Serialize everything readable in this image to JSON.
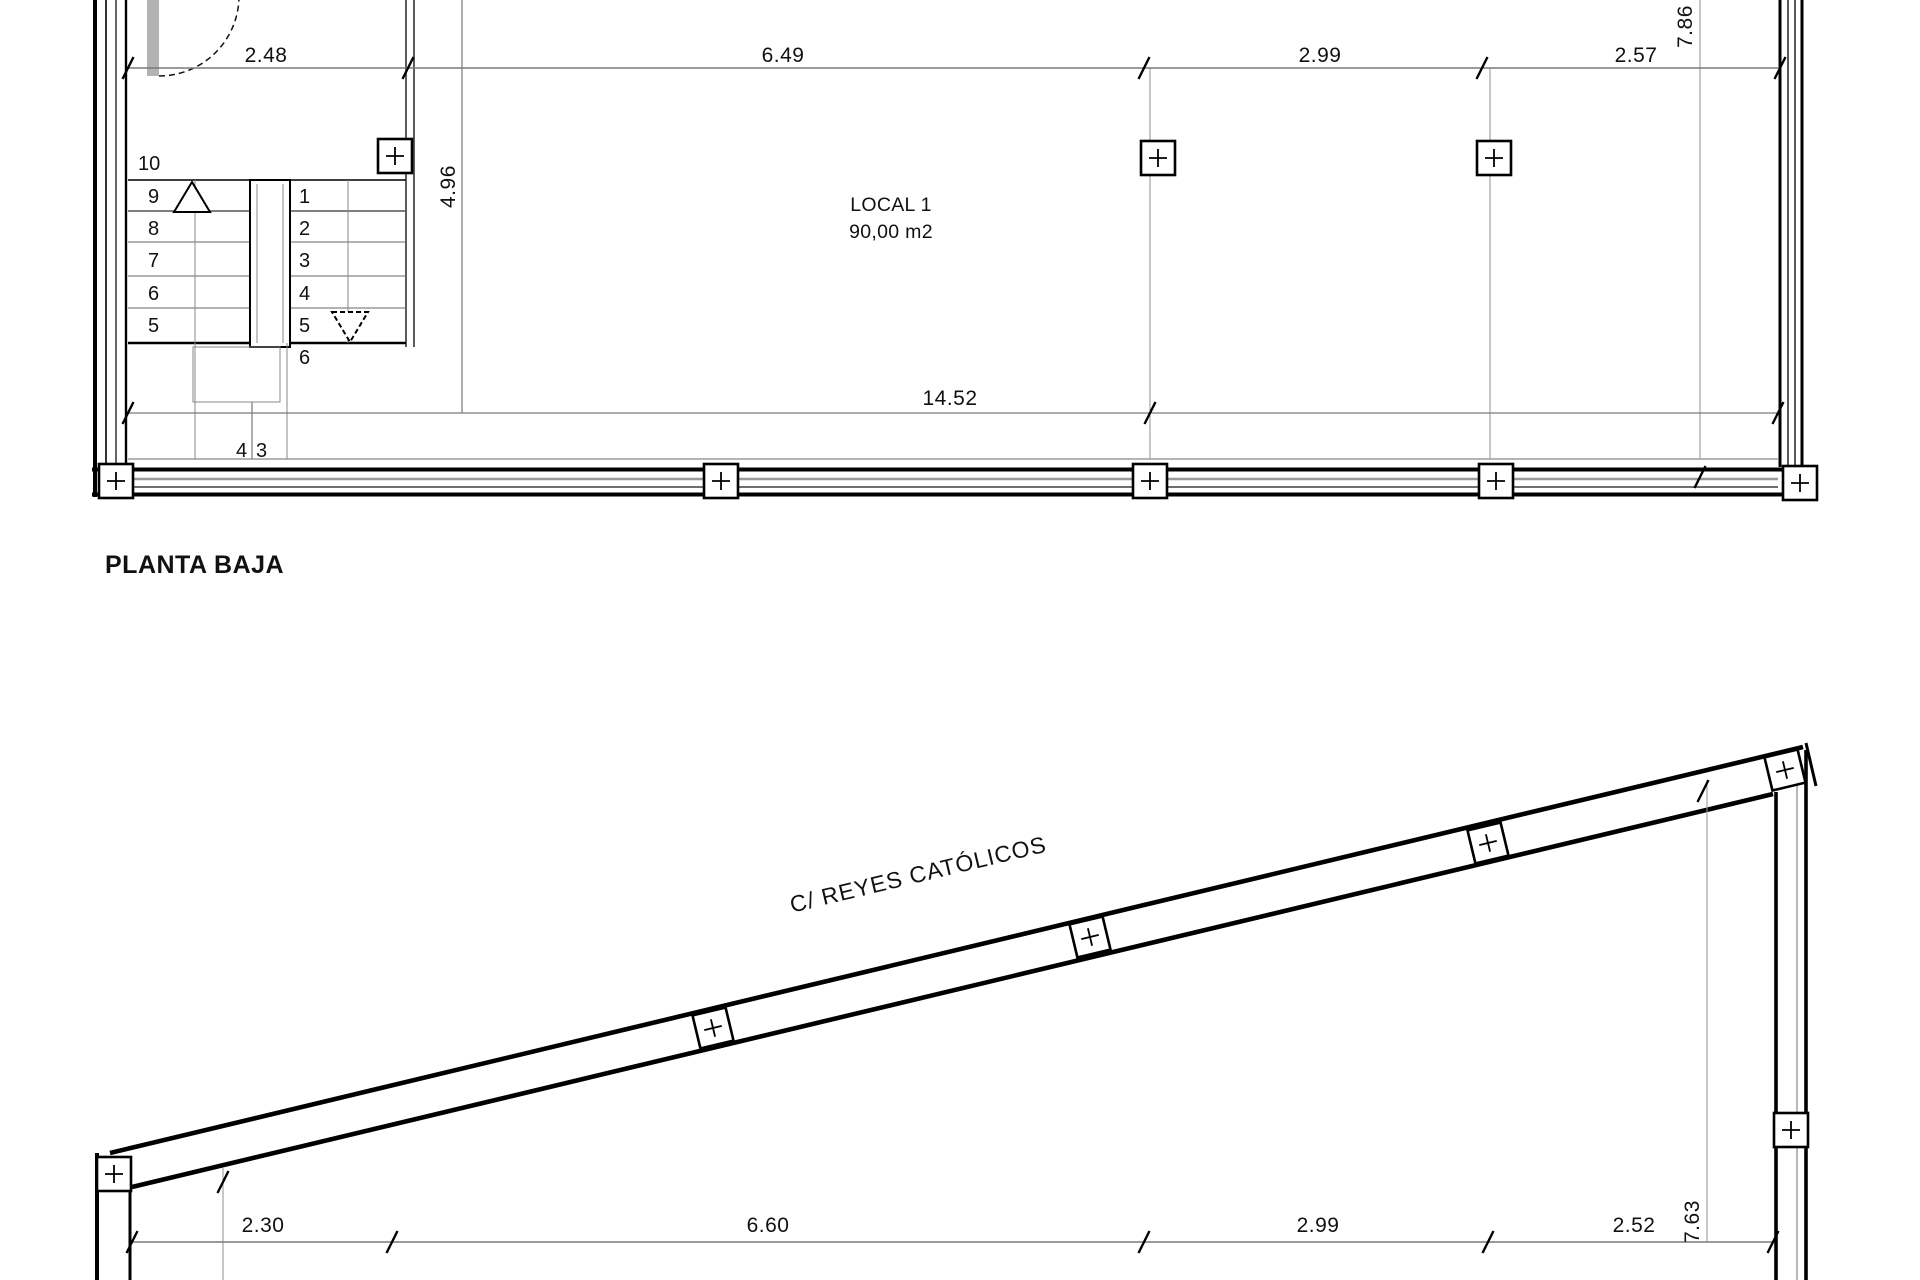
{
  "colors": {
    "line": "#000000",
    "dim_line": "#7a7a7a",
    "thin_line": "#9a9a9a",
    "door_leaf": "#b3b3b3",
    "background": "#ffffff"
  },
  "planta_baja": {
    "title": "PLANTA BAJA",
    "room": {
      "name": "LOCAL 1",
      "area": "90,00 m2"
    },
    "dimensions": {
      "top": [
        "2.48",
        "6.49",
        "2.99",
        "2.57"
      ],
      "right_vertical": "7.86",
      "stair_vertical": "4.96",
      "bottom_total": "14.52"
    },
    "stair": {
      "label_top": "10",
      "left_steps": [
        "9",
        "8",
        "7",
        "6",
        "5"
      ],
      "right_steps": [
        "1",
        "2",
        "3",
        "4",
        "5",
        "6"
      ],
      "bottom_steps": [
        "4",
        "3"
      ]
    }
  },
  "street_plan": {
    "street_name": "C/ REYES CATÓLICOS",
    "dimensions": {
      "bottom": [
        "2.30",
        "6.60",
        "2.99",
        "2.52"
      ],
      "right_vertical": "7.63"
    }
  }
}
